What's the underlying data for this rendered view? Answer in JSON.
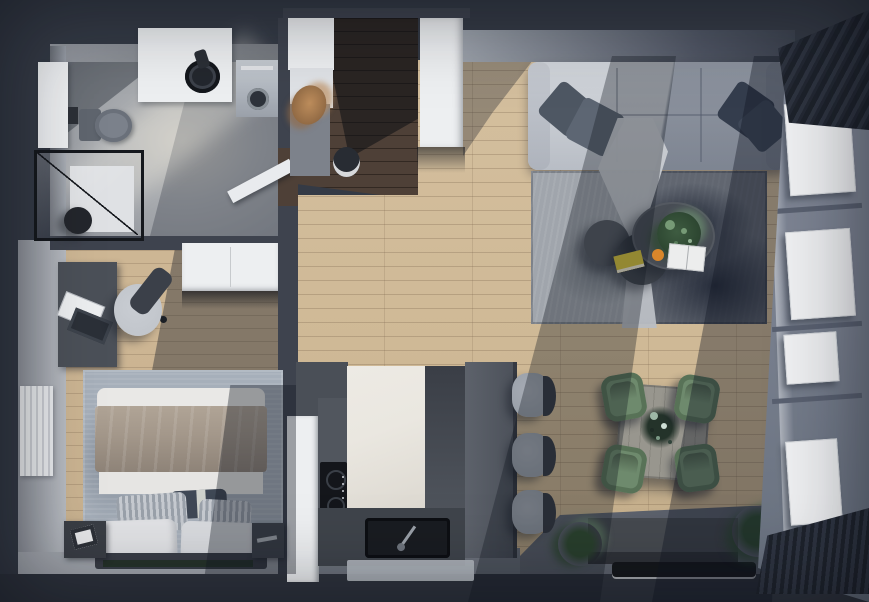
{
  "meta": {
    "title": "3D apartment floor plan, top-down render",
    "view": "top-down axonometric",
    "canvas": {
      "width": 869,
      "height": 602
    }
  },
  "palette": {
    "bg": "#343a45",
    "outerDark": "#2e333d",
    "wallDark": "#3e434e",
    "wallFace": "#9aa0a9",
    "wallFaceLight": "#b7bbc1",
    "concrete": "#a7aaae",
    "concreteDark": "#8f939a",
    "woodLight": "#cfb996",
    "hallWood": "#4e4037",
    "bedroomWood": "#c9b290",
    "white": "#edeff1",
    "offWhite": "#dfe1e4",
    "doorWhite": "#e9ebee",
    "sofaLight": "#c9cdd3",
    "pillowDark": "#5a6370",
    "rugLight": "#a0a5ac",
    "rugDark": "#2c3440",
    "bedroomRug": "#a6afba",
    "duvet": "#e9e8e6",
    "blanket": "#a3978a",
    "sheetWhite": "#e6e5e3",
    "headboard": "#3a3e47",
    "benchGreen": "#26332a",
    "deskGray": "#4b5058",
    "chairSeat": "#c1c5cb",
    "chairBack": "#3b4049",
    "cabinetDark": "#51565e",
    "counterWhite": "#eae7e0",
    "cooktopBlack": "#14161b",
    "sinkBlack": "#191c21",
    "stoolSeat": "#99a0a9",
    "stoolBack": "#363b44",
    "chairGreen": "#6e8a6d",
    "chairGreenDark": "#587257",
    "tableWood": "#98968e",
    "coffeeTable": "#484d55",
    "coffeeTableMid": "#3f444c",
    "coffeeTableLight": "#555a62",
    "tvBlack": "#15171b",
    "consoleGray": "#45494f",
    "plantGreen": "#3e5c41",
    "plantLight": "#769a76",
    "pampas": "#bd8d5c",
    "curtain": "#232831",
    "windowWall": "#79808f",
    "windowWhite": "#eff0f2",
    "matGray": "#b3b8bf",
    "washerGray": "#b6bcc4",
    "accentYellow": "#d6c23c",
    "accentOrange": "#d8862b",
    "bookWhite": "#eceded"
  },
  "rooms": [
    {
      "id": "bathroom",
      "label": "Bathroom",
      "furniture": [
        "vanity cabinet",
        "counter with round vessel sink",
        "wall-hung toilet",
        "walk-in shower with black frame",
        "washing machine",
        "plant stool",
        "open door"
      ]
    },
    {
      "id": "hallway",
      "label": "Entry hallway",
      "furniture": [
        "white wardrobe closets",
        "gray lower cabinet",
        "pampas grass",
        "round pouf"
      ]
    },
    {
      "id": "bedroom",
      "label": "Bedroom",
      "furniture": [
        "double bed with taupe blanket and pillows",
        "two nightstands",
        "desk",
        "office chair",
        "laptop",
        "white wardrobe",
        "radiator",
        "blue-gray rug"
      ]
    },
    {
      "id": "kitchen",
      "label": "Kitchen",
      "furniture": [
        "tall white cabinet",
        "dark counter with induction cooktop",
        "marble island",
        "black sink with faucet",
        "three bar stools",
        "floor mat"
      ]
    },
    {
      "id": "living",
      "label": "Living room",
      "furniture": [
        "light gray sofa with pillows and throw",
        "textured gray rug",
        "three round nesting coffee tables",
        "potted plant",
        "open book",
        "yellow book",
        "orange",
        "media console",
        "tv",
        "floor plants"
      ]
    },
    {
      "id": "dining",
      "label": "Dining area",
      "furniture": [
        "square wood table",
        "four green chairs",
        "plant centerpiece"
      ]
    },
    {
      "id": "window-wall",
      "label": "Window wall",
      "furniture": [
        "four windows",
        "dark pleated curtains"
      ]
    }
  ]
}
